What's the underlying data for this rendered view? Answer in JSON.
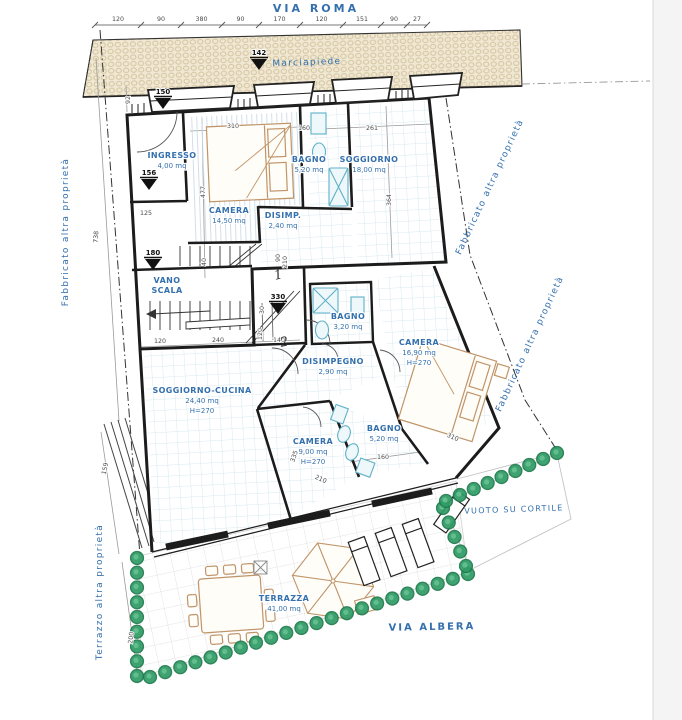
{
  "colors": {
    "label_blue": "#3470ad",
    "dim_gray": "#4a4a4a",
    "wall_black": "#1c1c1c",
    "hedge": "#2f9c66",
    "hedge_dark": "#1e7a4c",
    "furniture_tan": "#c09468",
    "fixture_cyan": "#5fb0c8",
    "tile_grid": "#cde4ec",
    "sidewalk_bg": "#f0e8d4",
    "sidewalk_dot": "#d4c49c",
    "page_edge": "#f4f4f5"
  },
  "streets": {
    "via_roma": "VIA ROMA",
    "via_albera": "VIA ALBERA"
  },
  "area_labels": [
    {
      "id": "marciapiede",
      "text": "Marciapiede",
      "x": 307,
      "y": 65,
      "rot": -2,
      "size": 9
    },
    {
      "id": "vuoto-su-cortile",
      "text": "VUOTO SU CORTILE",
      "x": 514,
      "y": 512,
      "rot": -2,
      "size": 8
    },
    {
      "id": "fabbricato-left",
      "text": "Fabbricato altra proprietà",
      "x": 68,
      "y": 232,
      "rot": -90,
      "size": 9
    },
    {
      "id": "fabbricato-right-upper",
      "text": "Fabbricato altra proprietà",
      "x": 492,
      "y": 188,
      "rot": -65,
      "size": 9
    },
    {
      "id": "fabbricato-right-lower",
      "text": "Fabbricato altra proprietà",
      "x": 532,
      "y": 345,
      "rot": -65,
      "size": 9
    },
    {
      "id": "terrazzo-left",
      "text": "Terrazzo altra proprietà",
      "x": 102,
      "y": 592,
      "rot": -90,
      "size": 9
    }
  ],
  "rooms": [
    {
      "id": "ingresso",
      "lines": [
        "INGRESSO",
        "4,00 mq"
      ],
      "bold": 1,
      "x": 172,
      "y": 158
    },
    {
      "id": "camera-14",
      "lines": [
        "CAMERA",
        "14,50 mq"
      ],
      "bold": 1,
      "x": 229,
      "y": 213
    },
    {
      "id": "disimp",
      "lines": [
        "DISIMP.",
        "2,40 mq"
      ],
      "bold": 1,
      "x": 283,
      "y": 218
    },
    {
      "id": "bagno-520-up",
      "lines": [
        "BAGNO",
        "5,20 mq"
      ],
      "bold": 1,
      "x": 309,
      "y": 162
    },
    {
      "id": "soggiorno",
      "lines": [
        "SOGGIORNO",
        "18,00 mq"
      ],
      "bold": 1,
      "x": 369,
      "y": 162
    },
    {
      "id": "vano-scala",
      "lines": [
        "VANO",
        "SCALA"
      ],
      "bold": 2,
      "x": 167,
      "y": 283
    },
    {
      "id": "soggiorno-cucina",
      "lines": [
        "SOGGIORNO-CUCINA",
        "24,40 mq",
        "H=270"
      ],
      "bold": 1,
      "x": 202,
      "y": 393
    },
    {
      "id": "bagno-320",
      "lines": [
        "BAGNO",
        "3,20 mq"
      ],
      "bold": 1,
      "x": 348,
      "y": 319
    },
    {
      "id": "disimpegno",
      "lines": [
        "DISIMPEGNO",
        "2,90 mq"
      ],
      "bold": 1,
      "x": 333,
      "y": 364
    },
    {
      "id": "camera-1690",
      "lines": [
        "CAMERA",
        "16,90 mq",
        "H=270"
      ],
      "bold": 1,
      "x": 419,
      "y": 345
    },
    {
      "id": "camera-900",
      "lines": [
        "CAMERA",
        "9,00 mq",
        "H=270"
      ],
      "bold": 1,
      "x": 313,
      "y": 444
    },
    {
      "id": "bagno-520-low",
      "lines": [
        "BAGNO",
        "5,20 mq"
      ],
      "bold": 1,
      "x": 384,
      "y": 431
    },
    {
      "id": "terrazza",
      "lines": [
        "TERRAZZA",
        "41,00 mq"
      ],
      "bold": 1,
      "x": 284,
      "y": 601
    }
  ],
  "markers": [
    {
      "value": "142",
      "x": 259,
      "y": 55
    },
    {
      "value": "150",
      "x": 163,
      "y": 94
    },
    {
      "value": "156",
      "x": 149,
      "y": 175
    },
    {
      "value": "180",
      "x": 153,
      "y": 255
    },
    {
      "value": "330",
      "x": 278,
      "y": 299
    }
  ],
  "top_dimensions": {
    "y": 25,
    "values": [
      "120",
      "90",
      "380",
      "90",
      "170",
      "120",
      "151",
      "90",
      "27"
    ],
    "ticks": [
      95,
      141,
      181,
      222,
      259,
      300,
      343,
      381,
      407,
      427
    ]
  },
  "dim_texts": [
    {
      "t": "310",
      "x": 233,
      "y": 128,
      "r": 0
    },
    {
      "t": "160",
      "x": 304,
      "y": 130,
      "r": 0
    },
    {
      "t": "261",
      "x": 372,
      "y": 130,
      "r": 0
    },
    {
      "t": "477",
      "x": 205,
      "y": 192,
      "r": -90
    },
    {
      "t": "364",
      "x": 391,
      "y": 200,
      "r": -90
    },
    {
      "t": "125",
      "x": 146,
      "y": 215,
      "r": 0
    },
    {
      "t": "92",
      "x": 130,
      "y": 100,
      "r": -90
    },
    {
      "t": "40",
      "x": 206,
      "y": 262,
      "r": -90
    },
    {
      "t": "90",
      "x": 280,
      "y": 258,
      "r": -90
    },
    {
      "t": "210",
      "x": 287,
      "y": 262,
      "r": -90
    },
    {
      "t": "120",
      "x": 160,
      "y": 343,
      "r": 0
    },
    {
      "t": "240",
      "x": 218,
      "y": 342,
      "r": 0
    },
    {
      "t": "120",
      "x": 262,
      "y": 334,
      "r": -90
    },
    {
      "t": "30",
      "x": 264,
      "y": 310,
      "r": -90
    },
    {
      "t": "140",
      "x": 279,
      "y": 342,
      "r": 0
    },
    {
      "t": "160",
      "x": 383,
      "y": 459,
      "r": 0
    },
    {
      "t": "310",
      "x": 452,
      "y": 439,
      "r": 24
    },
    {
      "t": "210",
      "x": 320,
      "y": 481,
      "r": 24
    },
    {
      "t": "335",
      "x": 296,
      "y": 457,
      "r": -70
    },
    {
      "t": "738",
      "x": 98,
      "y": 237,
      "r": -87
    },
    {
      "t": "159",
      "x": 107,
      "y": 469,
      "r": -78
    },
    {
      "t": "200",
      "x": 133,
      "y": 638,
      "r": -83
    }
  ],
  "unit_numbers": [
    {
      "text": "1",
      "x": 279,
      "y": 279
    },
    {
      "text": "2",
      "x": 285,
      "y": 346
    }
  ],
  "hedge_segments": [
    {
      "x1": 137,
      "y1": 558,
      "x2": 137,
      "y2": 676,
      "n": 9
    },
    {
      "x1": 150,
      "y1": 677,
      "x2": 468,
      "y2": 574,
      "n": 22
    },
    {
      "x1": 466,
      "y1": 566,
      "x2": 443,
      "y2": 508,
      "n": 5
    },
    {
      "x1": 446,
      "y1": 501,
      "x2": 557,
      "y2": 453,
      "n": 9
    }
  ]
}
